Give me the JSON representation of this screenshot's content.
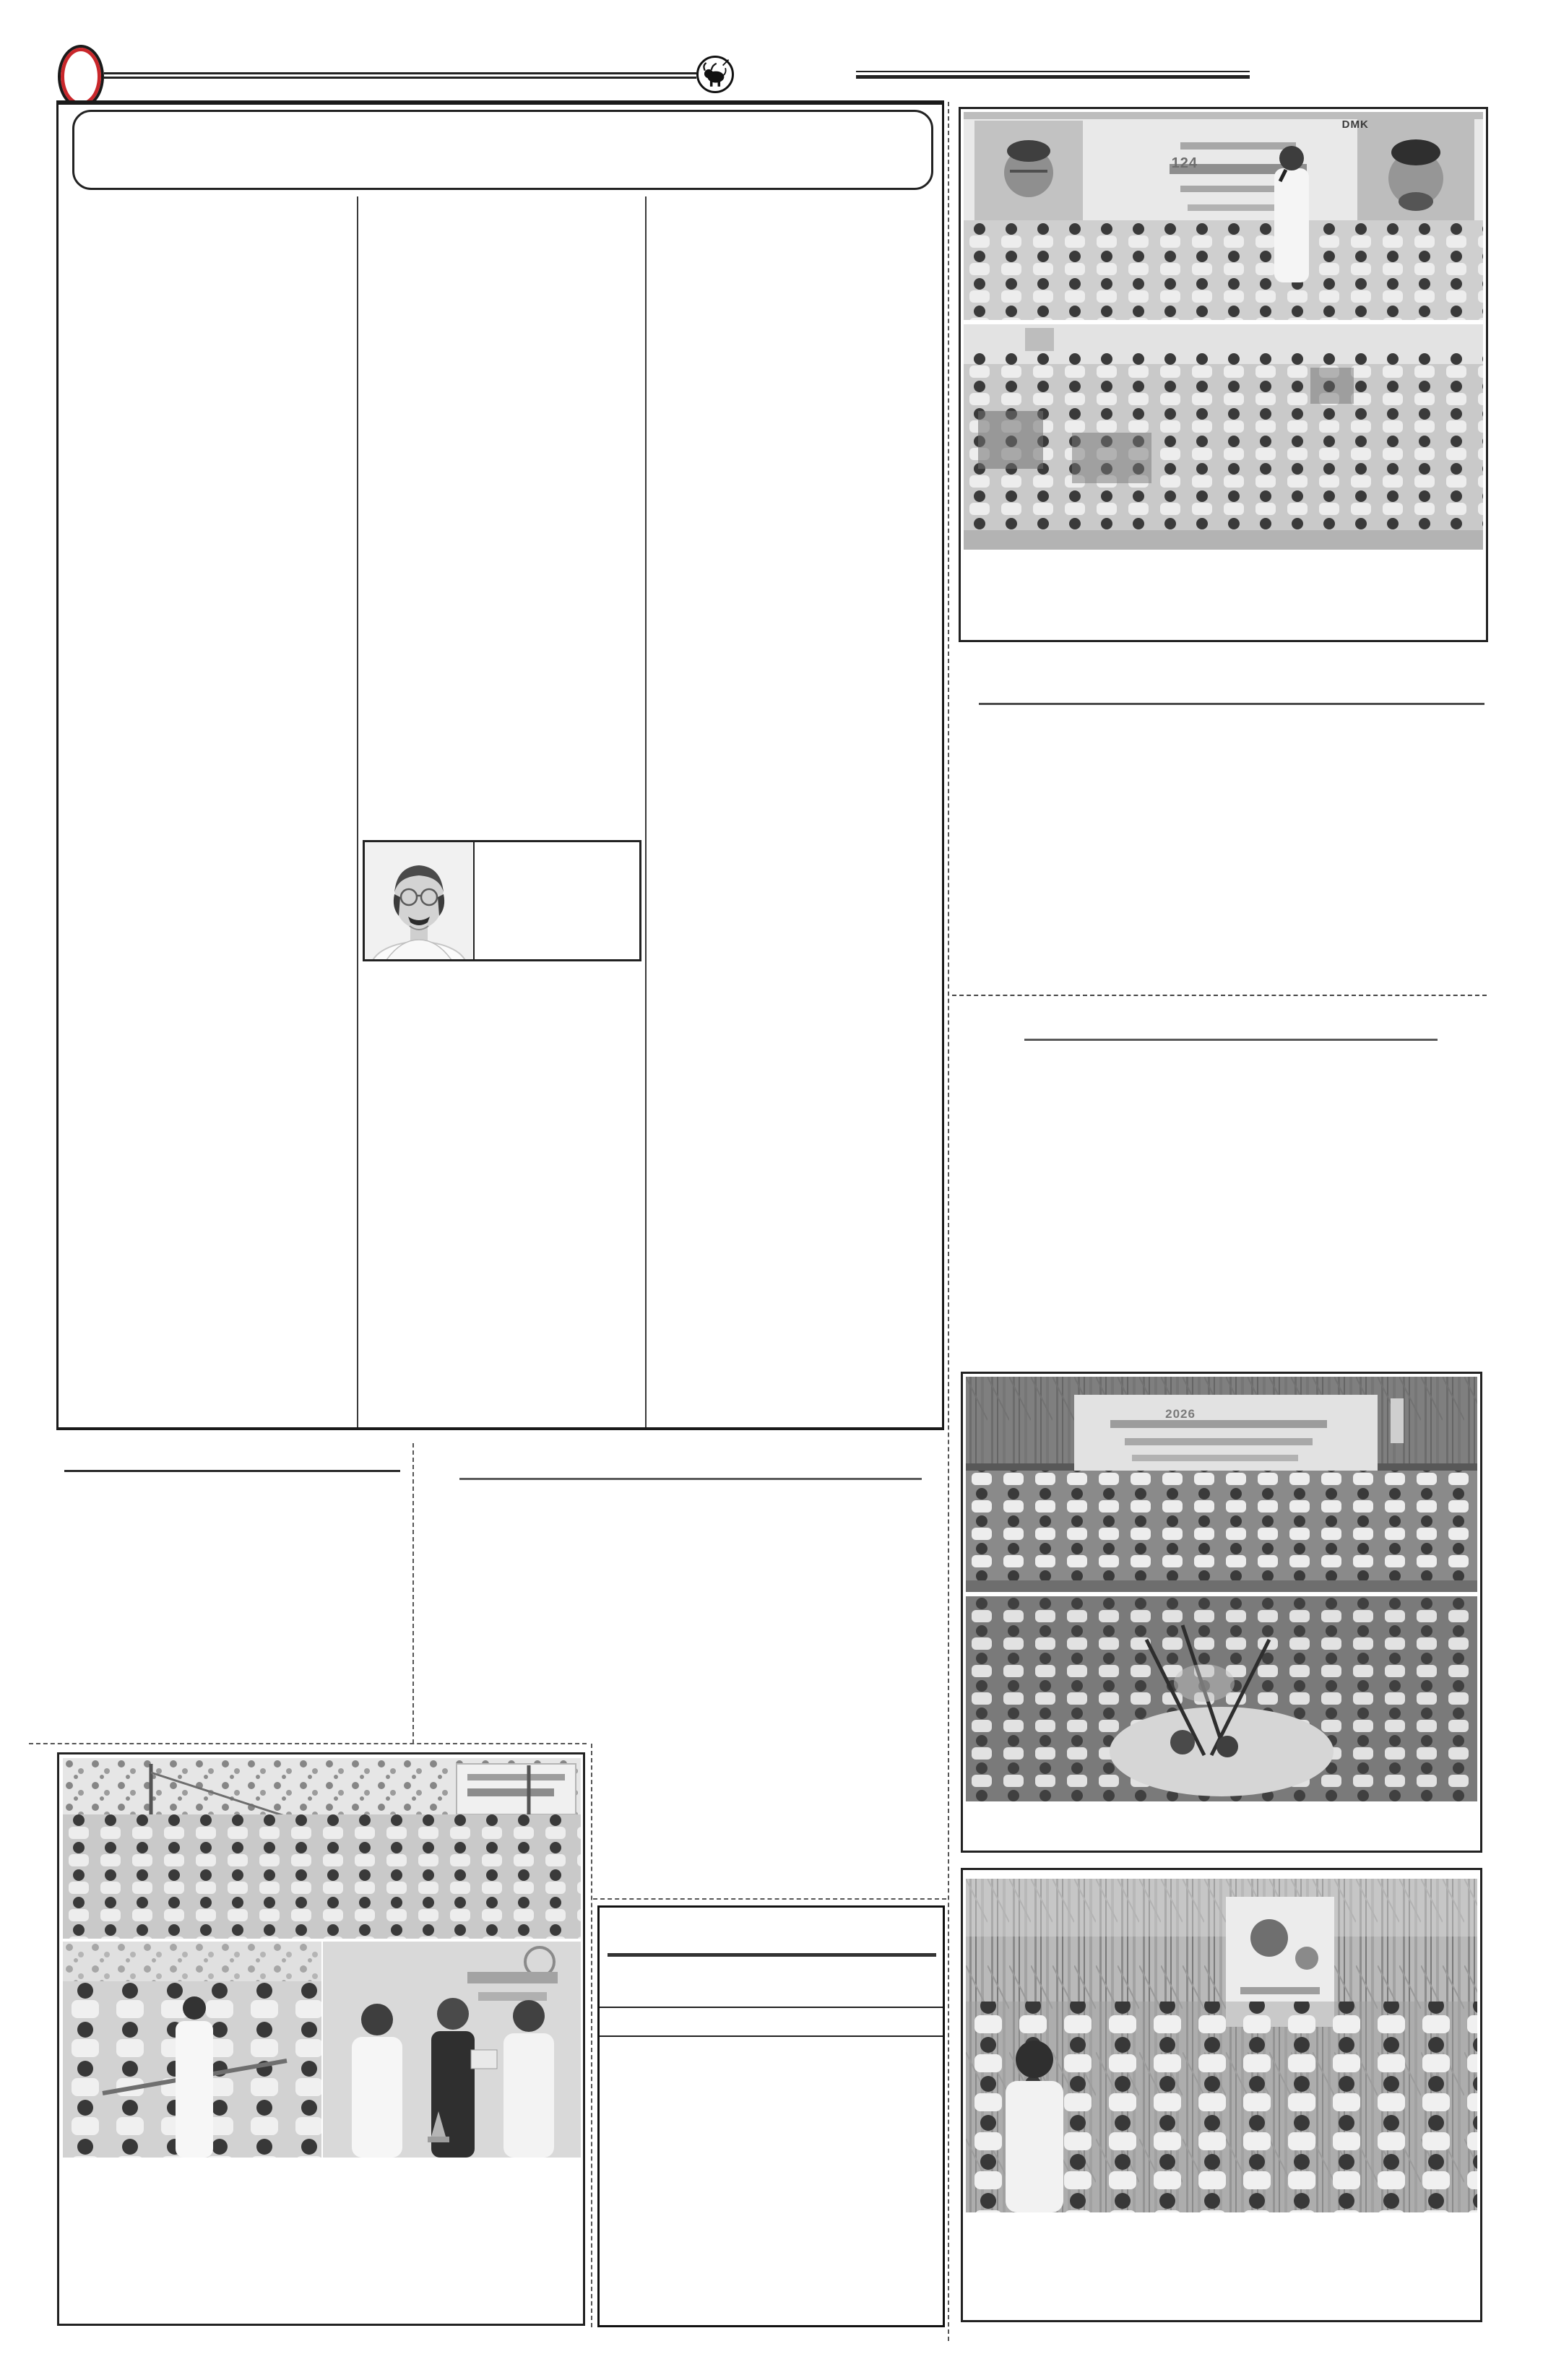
{
  "page": {
    "kind": "newspaper page proof scan",
    "background": "#ffffff",
    "ink_color": "#1a1a1a",
    "registration_mark_color": "#c9272b"
  },
  "header": {
    "registration_mark": "red-oval-registration-mark",
    "emblem": "circular bull emblem between top rules",
    "masthead_box": "empty rounded masthead box"
  },
  "main_box": {
    "columns": 3,
    "content": "blank article area (text layer not rendered)",
    "inline_photo": {
      "left_cell": "head-and-shoulders photo of smiling man with glasses and mustache in white shirt",
      "right_cell": "empty caption panel"
    }
  },
  "left_section": {
    "rule": "solid section rule",
    "photo_block": {
      "top_photo": "outdoor Pongal event, large crowd under trees, banner at top right",
      "bottom_left_photo": "officials in white shirts cutting sugarcane ribbon",
      "bottom_right_photo": "memento presented to man in black shirt before banner with ring motif",
      "caption_area": "blank"
    }
  },
  "middle_section": {
    "rule": "solid section rule",
    "notice_box": {
      "header_rule": "thick centered rule",
      "band_lines": 2,
      "content": "blank notice / advertisement box"
    }
  },
  "right_column": {
    "block_top": {
      "photo_a": {
        "description": "speaker with microphone and seated functionaries before backdrop with two leader portraits",
        "banner_label_1": "DMK",
        "banner_label_2": "124"
      },
      "photo_b": "audience seated at hall function, women in sarees left, men in white right",
      "caption_area": "blank"
    },
    "divider_1": "solid rule",
    "divider_2": "dotted rule",
    "divider_3": "solid rule",
    "block_middle": {
      "photo_a": {
        "description": "prize winners lined up on stage at night before banner",
        "banner_label": "2026"
      },
      "photo_b": "crowd around Pongal pots boiling amid tied sugarcane",
      "caption_area": "blank"
    },
    "block_bottom": {
      "photo": "party members in white shirts standing among sugarcane stalks, leader poster behind",
      "caption_area": "blank"
    }
  }
}
